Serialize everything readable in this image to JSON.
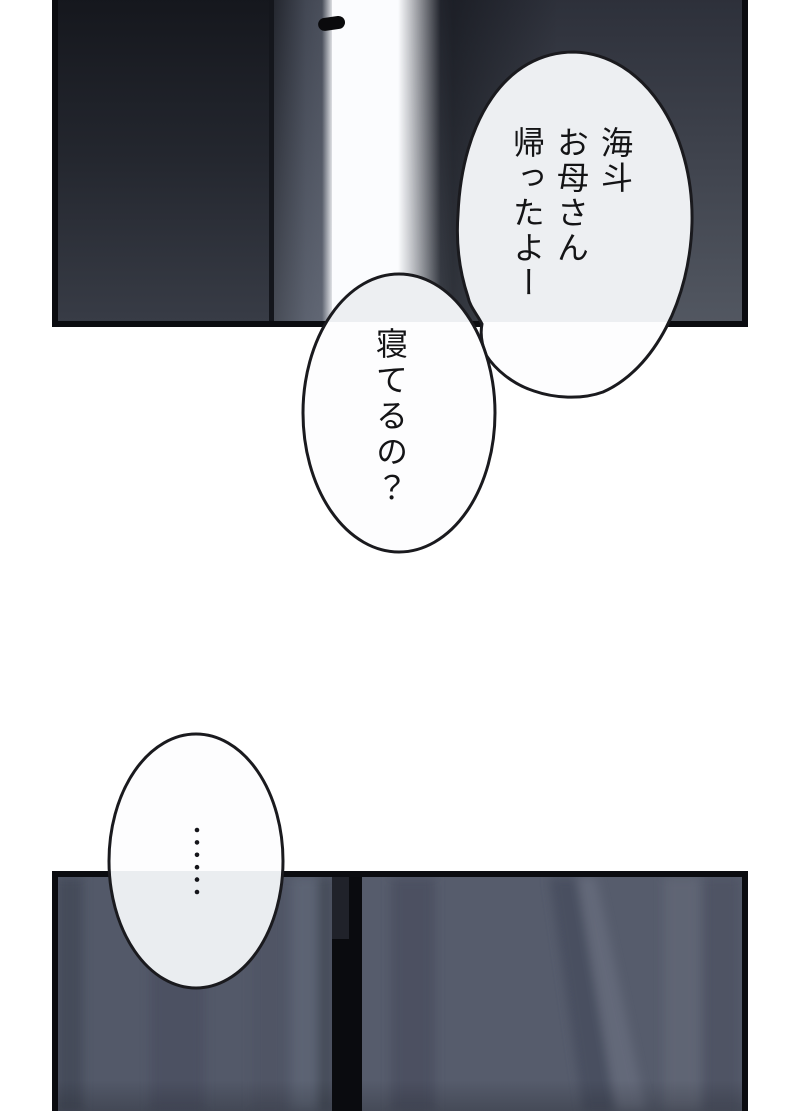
{
  "page": {
    "kind": "manga-page",
    "background": "#ffffff",
    "width": 800,
    "height": 1111
  },
  "panels": {
    "door_panel": {
      "description": "dark room, door ajar with bright light through the opening",
      "elements": [
        "door-slab",
        "door-edge",
        "light-gap",
        "door-handle",
        "shadow-wall"
      ]
    },
    "curtain_panel": {
      "description": "dark curtains with a black gap between them",
      "elements": [
        "curtain-left",
        "curtain-gap",
        "curtain-right"
      ]
    }
  },
  "dialogue": {
    "bubble1": {
      "lines": [
        "海斗",
        "お母さん",
        "帰ったよー"
      ]
    },
    "bubble2": {
      "text": "寝てるの？"
    },
    "bubble3": {
      "text": "……"
    }
  },
  "palette": {
    "border_black": "#0b0c10",
    "door_dark_top": "#15171d",
    "door_dark_bottom": "#383c46",
    "wall_top": "#2d303a",
    "wall_bottom": "#525761",
    "light_gap": "#fbfcfe",
    "curtain_base": "#565c6c",
    "curtain_fold_dark": "#4c5262",
    "curtain_fold_light": "#636979",
    "bubble_fill": "#fdfdfe",
    "bubble_fill_over_panel": "#edeff2",
    "ink": "#141416"
  }
}
